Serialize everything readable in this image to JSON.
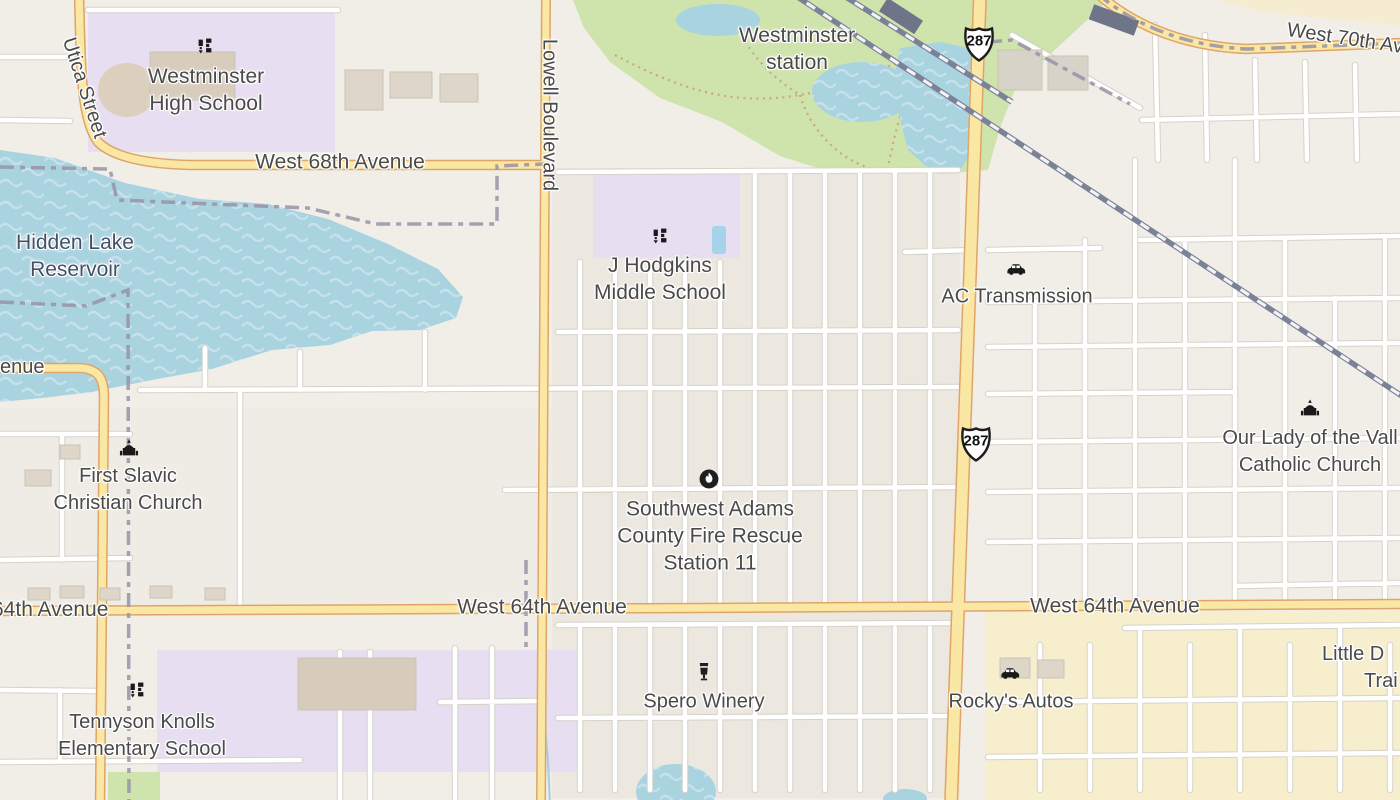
{
  "map_title": "Westminster area street map",
  "colors": {
    "background": "#f1eee8",
    "water": "#aad3e0",
    "water_wave": "#c6e1eb",
    "park": "#cfe3ac",
    "school_area": "#e7def1",
    "commercial_area": "#f7eecd",
    "road_major_fill": "#fbe7a4",
    "road_major_casing": "#dfa566",
    "road_minor_fill": "#ffffff",
    "road_minor_casing": "#d6d2c9",
    "railway": "#7b8297",
    "admin_boundary": "#9793a6",
    "label_text": "#4a4a4a",
    "water_label_text": "#445066",
    "building": "#ddd6c9"
  },
  "labels": {
    "westminster_high_school": {
      "line1": "Westminster",
      "line2": "High School"
    },
    "utica_street": "Utica Street",
    "westminster_station": {
      "line1": "Westminster",
      "line2": "station"
    },
    "west_70th": "West 70th Av",
    "west_68th": "West 68th Avenue",
    "lowell_boulevard": "Lowell Boulevard",
    "hidden_lake": {
      "line1": "Hidden Lake",
      "line2": "Reservoir"
    },
    "j_hodgkins": {
      "line1": "J Hodgkins",
      "line2": "Middle School"
    },
    "ac_transmission": "AC Transmission",
    "avenue_partial": "venue",
    "first_slavic": {
      "line1": "First Slavic",
      "line2": "Christian Church"
    },
    "our_lady": {
      "line1": "Our Lady of the Vall",
      "line2": "Catholic Church"
    },
    "fire_station": {
      "line1": "Southwest Adams",
      "line2": "County Fire Rescue",
      "line3": "Station 11"
    },
    "west_64th_left": "64th Avenue",
    "west_64th_center": "West 64th Avenue",
    "west_64th_right": "West 64th Avenue",
    "spero_winery": "Spero Winery",
    "rockys_autos": "Rocky's Autos",
    "tennyson": {
      "line1": "Tennyson Knolls",
      "line2": "Elementary School"
    },
    "little_d": {
      "line1": "Little D",
      "line2": "Trai"
    },
    "us287": "287"
  },
  "icons": {
    "schools": [
      "westminster-high-school",
      "j-hodgkins-middle-school",
      "tennyson-knolls-elementary"
    ],
    "cars": [
      "ac-transmission",
      "rockys-autos"
    ],
    "churches": [
      "first-slavic-christian-church",
      "our-lady-catholic-church"
    ],
    "fire_station": "southwest-adams-fire-rescue-11",
    "winery": "spero-winery"
  }
}
